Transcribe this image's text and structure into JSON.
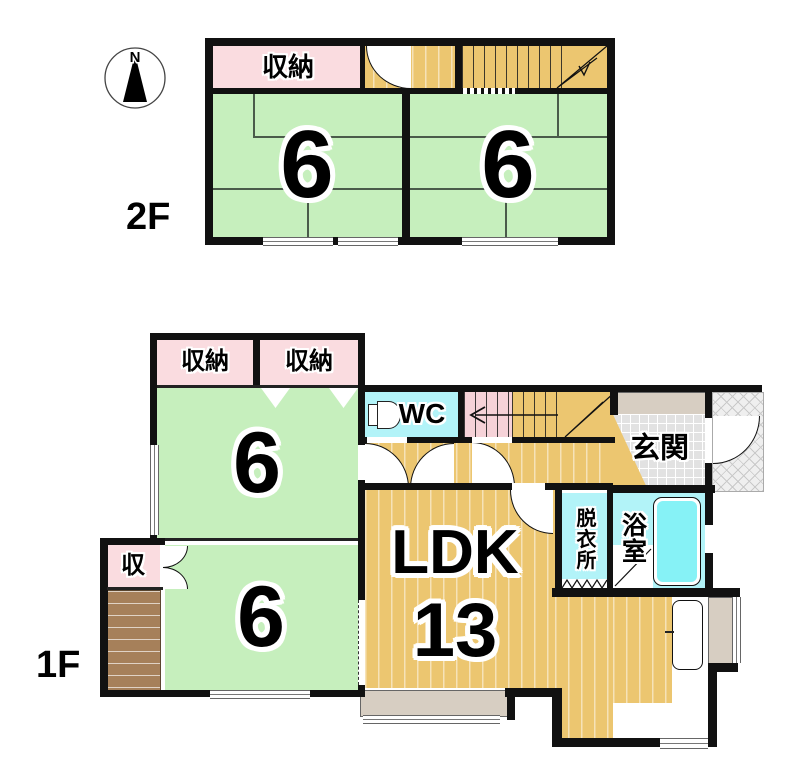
{
  "compass": {
    "label": "N"
  },
  "floor2": {
    "label": "2F",
    "storage": "収納",
    "room_a": "6",
    "room_b": "6"
  },
  "floor1": {
    "label": "1F",
    "storage_a": "収納",
    "storage_b": "収納",
    "storage_small": "収",
    "room_upper": "6",
    "room_lower": "6",
    "wc": "WC",
    "entrance": "玄関",
    "ldk": "LDK",
    "ldk_size": "13",
    "dressing": "脱衣所",
    "bath": "浴室"
  },
  "colors": {
    "tatami_green": "#c6efbd",
    "storage_pink": "#fadce0",
    "floor_tan": "#ecc670",
    "stair_pink": "#f6d2d8",
    "water_cyan": "#b2f3f8",
    "tub_cyan": "#86f2f6",
    "deck_brown": "#a6805a",
    "bay_beige": "#d7cec2",
    "tile_gray": "#e2e2e2",
    "wall_black": "#111111"
  }
}
